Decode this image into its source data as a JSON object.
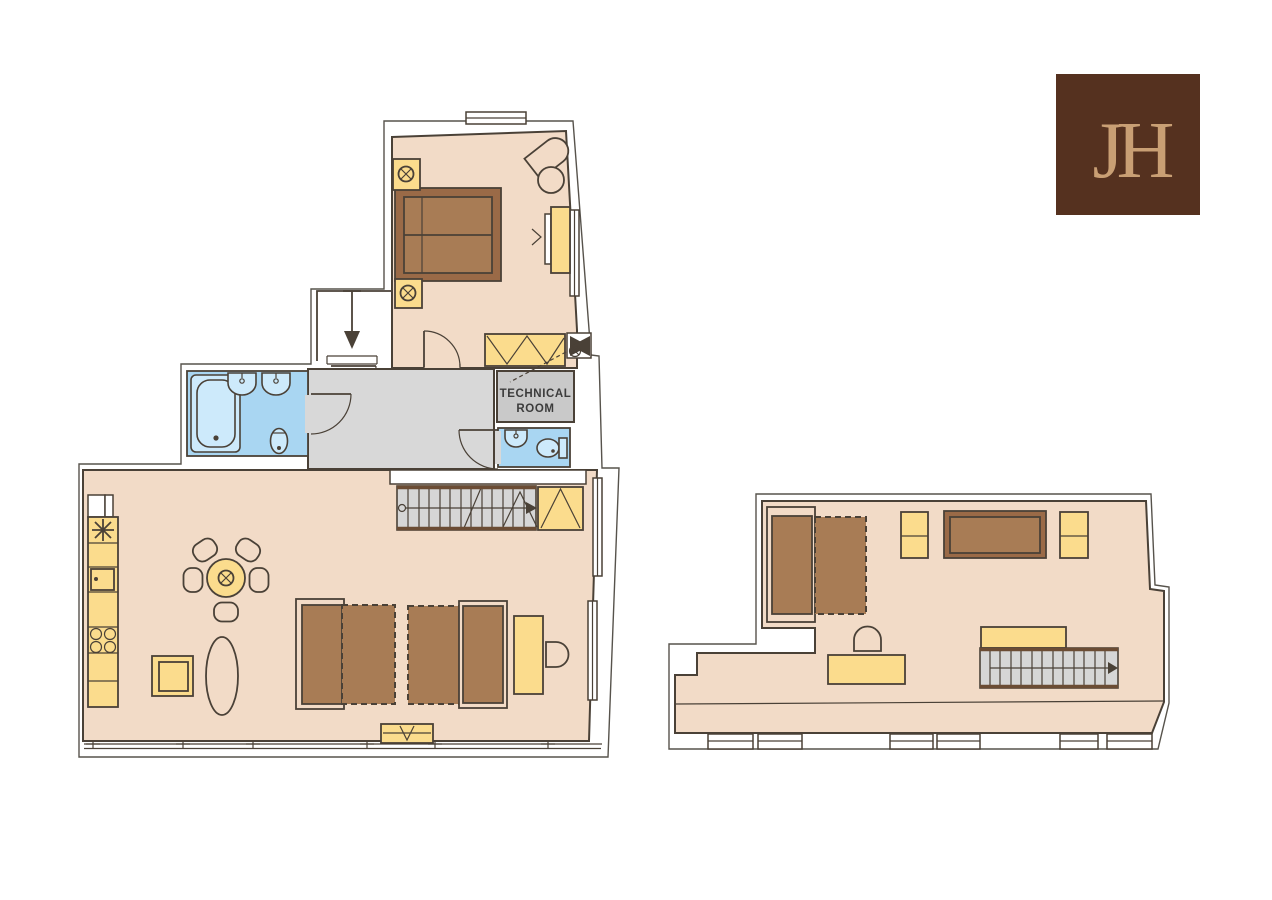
{
  "logo": {
    "monogram": "JH"
  },
  "labels": {
    "technical_room_line1": "TECHNICAL",
    "technical_room_line2": "ROOM"
  },
  "icons": {
    "ceiling_light": "circle-with-x",
    "extractor_star": "8-ray-asterisk",
    "entry_arrow": "down-arrow",
    "stair_up_arrow": "right-arrow",
    "fan_unit": "black-pinwheel"
  },
  "colors": {
    "background": "#ffffff",
    "floor": "#f2dbc7",
    "hallway": "#d8d8d8",
    "technical": "#c9c9c9",
    "stair": "#d6d6d6",
    "water": "#a9d6f2",
    "fixture": "#cdeafb",
    "yellow": "#fbdc8d",
    "seat": "#a87c55",
    "dark": "#9a6a47",
    "line": "#4a4137",
    "outline": "#57534c",
    "text": "#3c3c3c",
    "logo_bg": "#55311f",
    "logo_fg": "#c99f74"
  }
}
